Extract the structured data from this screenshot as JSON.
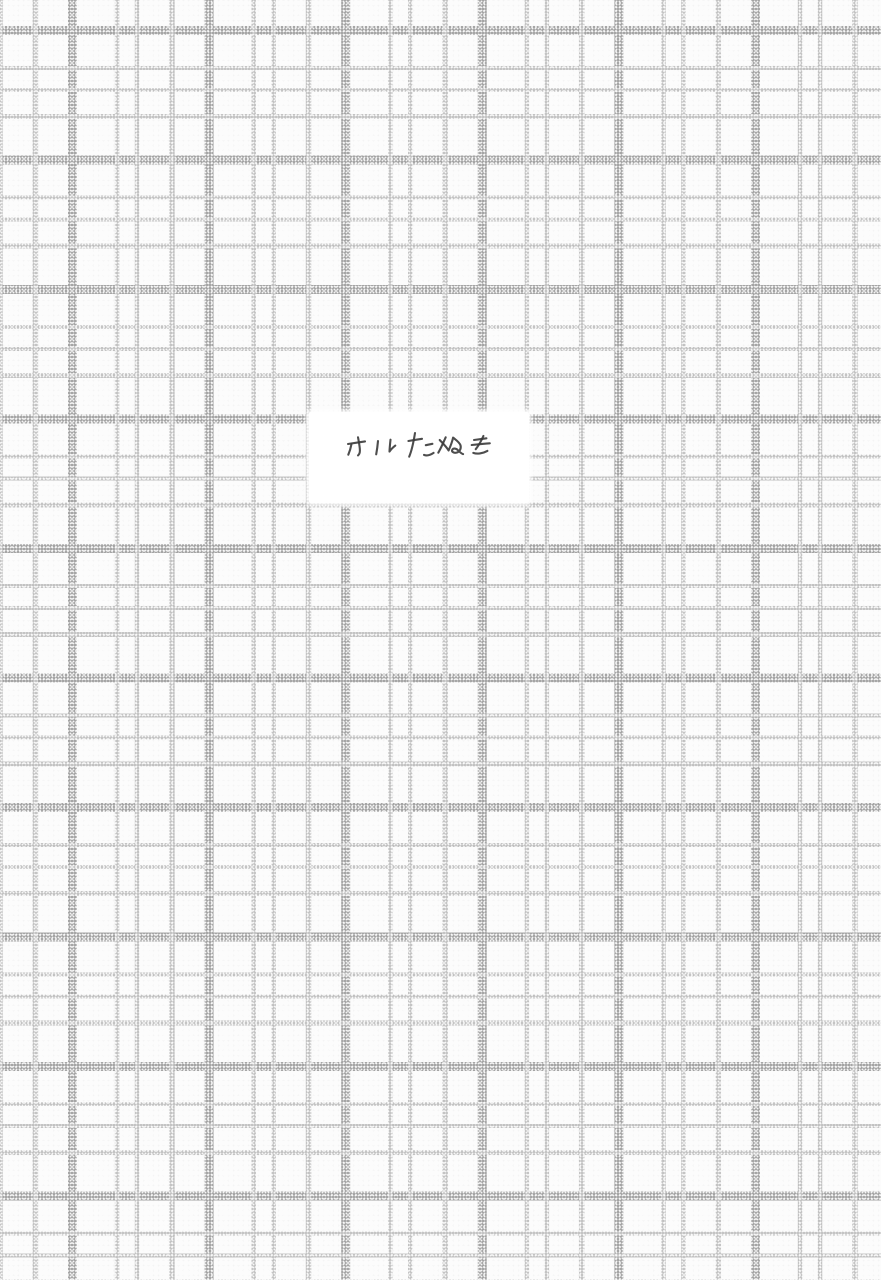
{
  "document": {
    "kind": "scanned plaid patterned book page with centered title sticker",
    "title_label": {
      "text": "カルたぬき"
    }
  },
  "colors": {
    "page-bg": "#fcfcfc",
    "grid-thick": "#a6a6a6",
    "grid-thin": "#c4c4c4",
    "label-bg": "#ffffff",
    "ink": "#3a3a3a"
  }
}
